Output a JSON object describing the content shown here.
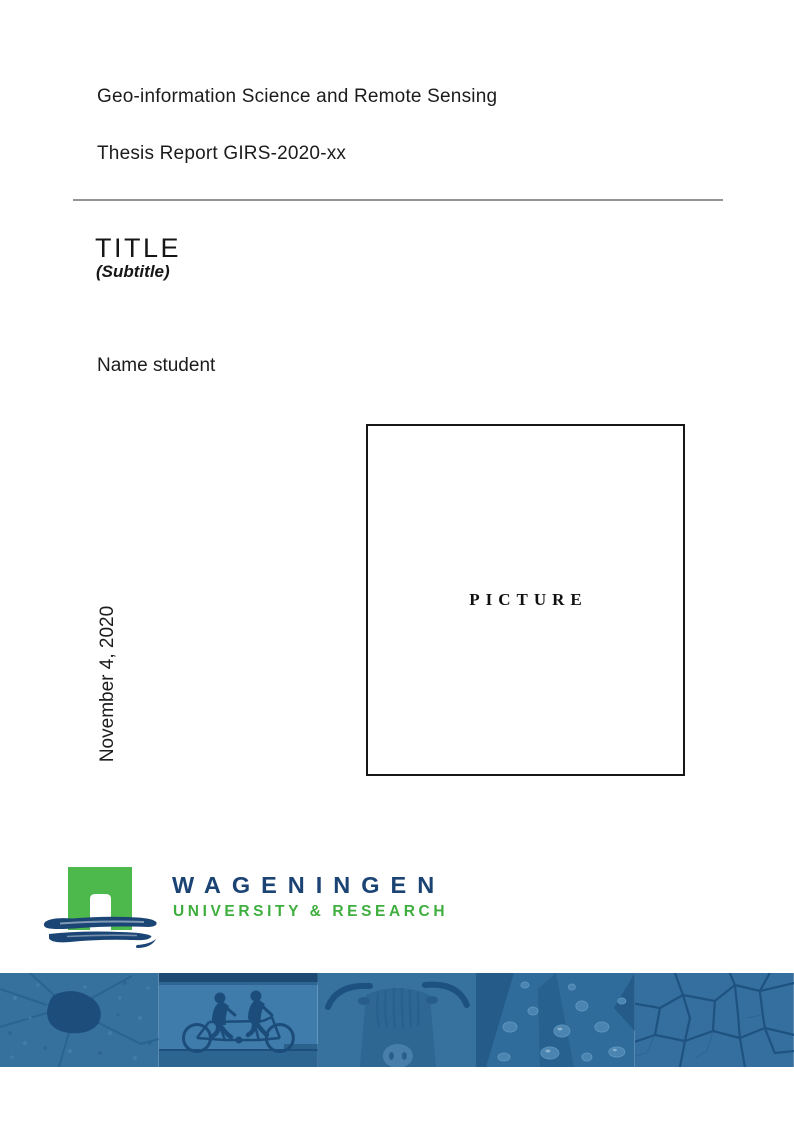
{
  "header": {
    "program": "Geo-information Science and Remote Sensing",
    "report_id": "Thesis Report GIRS-2020-xx"
  },
  "title": {
    "main": "TITLE",
    "subtitle": "(Subtitle)"
  },
  "author": {
    "name": "Name student"
  },
  "date": {
    "text": "November 4, 2020"
  },
  "picture": {
    "placeholder": "PICTURE"
  },
  "logo": {
    "name": "WAGENINGEN",
    "tagline": "UNIVERSITY & RESEARCH",
    "colors": {
      "green": "#4db84b",
      "blue": "#1a4574",
      "wordmark_blue": "#1b4373",
      "tagline_green": "#3eae3e"
    }
  },
  "banner": {
    "tint": "#2f6b9b",
    "photos": [
      "aerial-map",
      "tandem-cyclists",
      "highland-cow",
      "water-droplets",
      "cracked-earth"
    ]
  },
  "rule_color": "#949494"
}
